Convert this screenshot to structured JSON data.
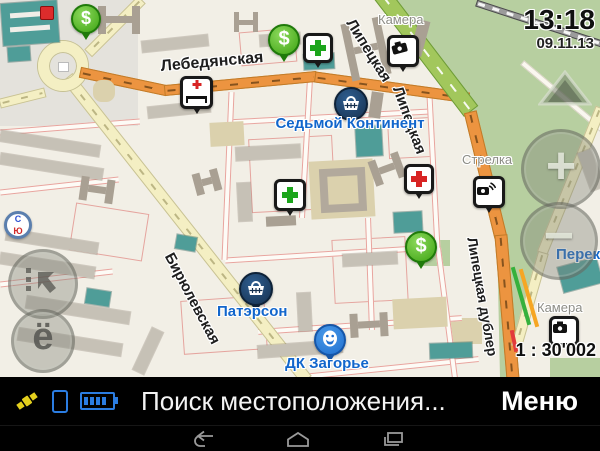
{
  "clock": {
    "time": "13:18",
    "date": "09.11.13"
  },
  "map": {
    "scale": "1 : 30'002",
    "streets": {
      "lebedyanskaya": "Лебедянская",
      "biryulevskaya": "Бирюлевская",
      "lipetskaya_top": "Липецкая",
      "lipetskaya_mid": "Липецкая",
      "lipetskaya_dubler": "Липецкая дублер"
    },
    "labels": {
      "sedmoy_kontinent": "Седьмой Континент",
      "paterson": "Патэрсон",
      "dk_zagorye": "ДК Загорье",
      "camera_top": "Камера",
      "camera_bottom": "Камера",
      "strelka": "Стрелка",
      "perekrestok": "Перекр"
    }
  },
  "statusbar": {
    "message": "Поиск местоположения...",
    "menu": "Меню"
  },
  "icon_glyphs": {
    "dollar": "$",
    "zoom_in": "+",
    "zoom_out": "−",
    "events": "ё",
    "compass_north": "С",
    "compass_south": "Ю"
  },
  "colors": {
    "poi_label": "#1266cc",
    "road_main": "#ec9440",
    "road_secondary": "#f4efc3",
    "road_highway": "#a2c75c",
    "park": "#b7cfa0",
    "building": "#c6c1b6",
    "building_teal": "#4f9d98",
    "status_icon_blue": "#2b7de2",
    "status_icon_yellow": "#e3cf1d",
    "bar_background": "#000000"
  }
}
